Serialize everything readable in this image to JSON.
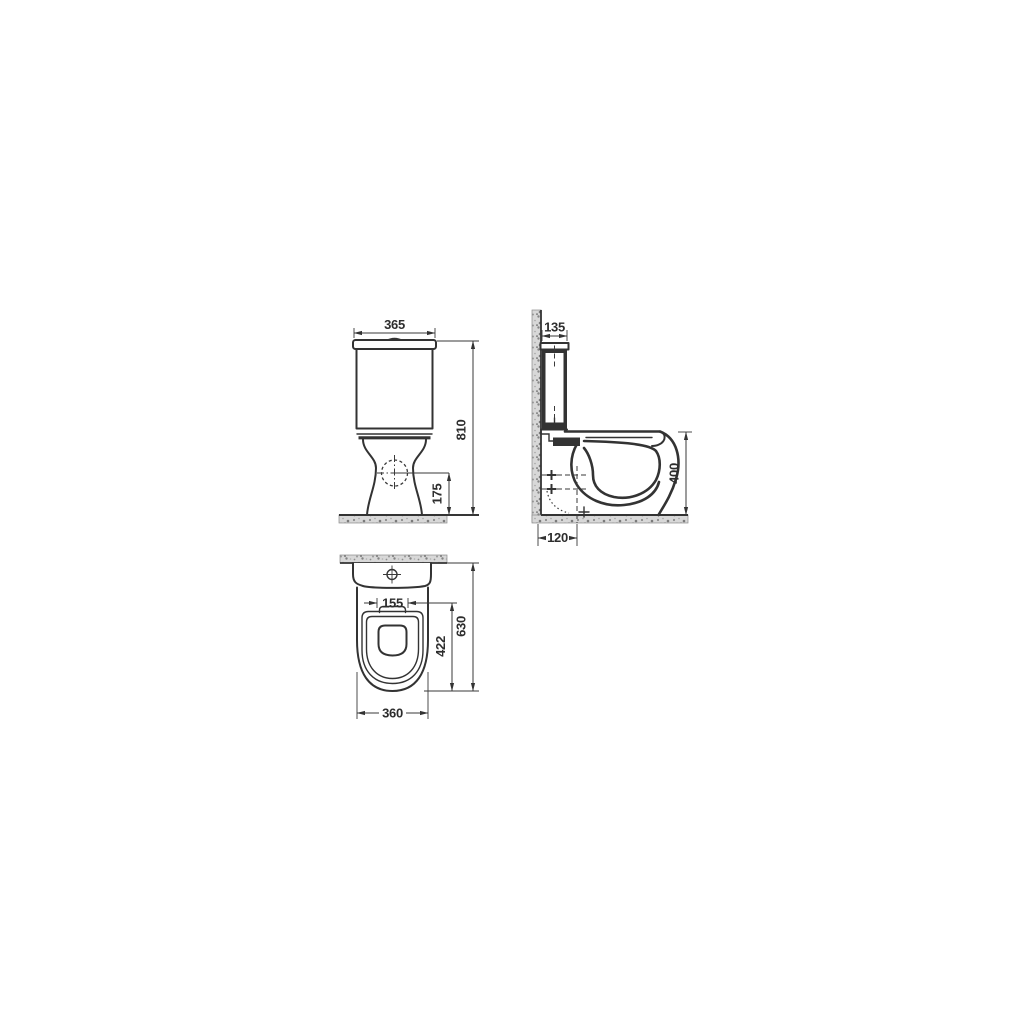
{
  "drawing": {
    "kind": "technical-dimension-drawing",
    "subject": "close-coupled toilet WC, three orthographic views"
  },
  "dims": {
    "front_width": "365",
    "front_height": "810",
    "outlet_height": "175",
    "cistern_depth": "135",
    "rim_height": "400",
    "outlet_setout": "120",
    "hinge_centers": "155",
    "overall_depth": "630",
    "seat_cutout": "422",
    "pan_width": "360"
  },
  "colors": {
    "background": "#ffffff",
    "line": "#333333",
    "text": "#2d2d2d",
    "section_fill": "#333333",
    "hatch_base": "#d8d8d8",
    "hatch_speck": "#8c8c8c"
  }
}
